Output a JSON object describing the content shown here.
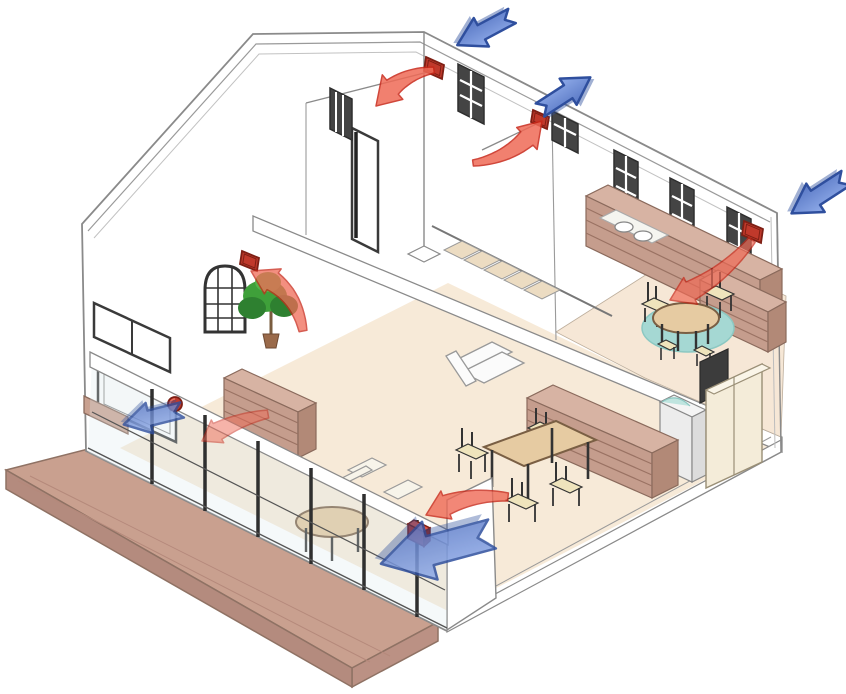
{
  "diagram": {
    "name": "house-ventilation-cutaway",
    "type": "isometric-architecture-airflow-diagram",
    "legend": {
      "blue_arrow": "outdoor fresh-air supply",
      "red_arrow": "indoor exhaust airflow",
      "red_box": "ventilation-unit"
    },
    "colors": {
      "wall_line": "#8a8a8a",
      "wall_fill": "#ffffff",
      "floor": "#f7ead8",
      "deck": "#c9a08f",
      "deck_side": "#bb9184",
      "deck_edge": "#8f7264",
      "wood": "#c59d8d",
      "wood_top": "#d7b3a3",
      "wood_dark": "#b28977",
      "wood_slat": "#9a7263",
      "rug": "#a5d8d3",
      "rug_edge": "#8cc8c2",
      "table": "#e6cba2",
      "table_edge": "#7a5f44",
      "seat": "#efe4bc",
      "frame_dark": "#333333",
      "glass": "#dce8ee",
      "supply": "#7f9ce0",
      "supply_light": "#cdddf8",
      "supply_dark": "#2f4f9e",
      "exhaust": "#ef6a56",
      "exhaust_dark": "#c82819",
      "vent": "#c0392b",
      "vent_dark": "#7e1f14",
      "plant": "#3fa03a",
      "plant_dark": "#2e8030",
      "plant_light": "#55b34a",
      "appliance": "#ececec",
      "cabinet": "#f4ecd9"
    },
    "rooms": [
      "upstairs-hall",
      "kitchen-dining-upstairs",
      "living-room",
      "dining-area",
      "utility-area",
      "deck"
    ],
    "furniture": [
      "kitchen-counter-with-stove",
      "kitchen-bench",
      "kitchen-oval-table",
      "kitchen-chairs",
      "teal-rug",
      "staircase",
      "sofa",
      "dining-table",
      "dining-chairs",
      "dining-shelf-unit",
      "left-sideboard",
      "round-table-living",
      "washing-machine",
      "tall-cabinet",
      "potted-plant",
      "window-sill-planter"
    ],
    "supply_arrows": [
      {
        "name": "supply-arrow-roof-left",
        "tail": [
          512,
          16
        ],
        "angle": 152,
        "scale": 0.62,
        "opacity": 1.0
      },
      {
        "name": "supply-arrow-roof-mid",
        "tail": [
          540,
          110
        ],
        "angle": -33,
        "scale": 0.6,
        "opacity": 1.0
      },
      {
        "name": "supply-arrow-right-wall",
        "tail": [
          846,
          178
        ],
        "angle": 147,
        "scale": 0.65,
        "opacity": 1.0
      },
      {
        "name": "supply-arrow-left-window",
        "tail": [
          182,
          410
        ],
        "angle": 166,
        "scale": 0.6,
        "opacity": 0.8
      },
      {
        "name": "supply-arrow-living-corner",
        "tail": [
          492,
          534
        ],
        "angle": 165,
        "scale": 1.15,
        "opacity": 0.85
      }
    ],
    "exhaust_arrows": [
      {
        "name": "exhaust-arrow-hall-left",
        "tail": [
          434,
          70
        ],
        "tip": [
          376,
          106
        ],
        "bulge": 16,
        "w0": 3,
        "wn": 9,
        "wh": 16,
        "head": 24,
        "opacity": 0.85
      },
      {
        "name": "exhaust-arrow-hall-right",
        "tail": [
          473,
          163
        ],
        "tip": [
          542,
          121
        ],
        "bulge": 18,
        "w0": 3,
        "wn": 9,
        "wh": 15,
        "head": 22,
        "opacity": 0.85
      },
      {
        "name": "exhaust-arrow-kitchen",
        "tail": [
          752,
          240
        ],
        "tip": [
          670,
          300
        ],
        "bulge": -14,
        "w0": 4,
        "wn": 10,
        "wh": 15,
        "head": 22,
        "opacity": 0.7
      },
      {
        "name": "exhaust-arrow-plant",
        "tail": [
          303,
          331
        ],
        "tip": [
          251,
          271
        ],
        "bulge": 24,
        "w0": 4,
        "wn": 10,
        "wh": 15,
        "head": 22,
        "opacity": 0.75
      },
      {
        "name": "exhaust-arrow-left-window",
        "tail": [
          268,
          414
        ],
        "tip": [
          202,
          441
        ],
        "bulge": 8,
        "w0": 4,
        "wn": 9,
        "wh": 13,
        "head": 18,
        "opacity": 0.5
      },
      {
        "name": "exhaust-arrow-living",
        "tail": [
          508,
          497
        ],
        "tip": [
          426,
          515
        ],
        "bulge": 14,
        "w0": 4,
        "wn": 10,
        "wh": 15,
        "head": 22,
        "opacity": 0.8
      }
    ],
    "vents": [
      {
        "name": "vent-hall-left",
        "shape": "panel",
        "pts": [
          [
            426,
            57
          ],
          [
            444,
            65
          ],
          [
            442,
            79
          ],
          [
            424,
            71
          ]
        ]
      },
      {
        "name": "vent-hall-right",
        "shape": "panel",
        "pts": [
          [
            533,
            110
          ],
          [
            549,
            117
          ],
          [
            547,
            129
          ],
          [
            531,
            122
          ]
        ]
      },
      {
        "name": "vent-gable-wall",
        "shape": "panel",
        "pts": [
          [
            242,
            251
          ],
          [
            259,
            258
          ],
          [
            257,
            271
          ],
          [
            240,
            264
          ]
        ]
      },
      {
        "name": "vent-kitchen",
        "shape": "panel",
        "pts": [
          [
            744,
            221
          ],
          [
            763,
            229
          ],
          [
            761,
            243
          ],
          [
            742,
            235
          ]
        ]
      },
      {
        "name": "vent-left-window",
        "shape": "ball",
        "at": [
          175,
          404
        ],
        "r": 7
      },
      {
        "name": "vent-living-corner",
        "shape": "box",
        "at": [
          408,
          520
        ],
        "size": 16
      }
    ]
  }
}
